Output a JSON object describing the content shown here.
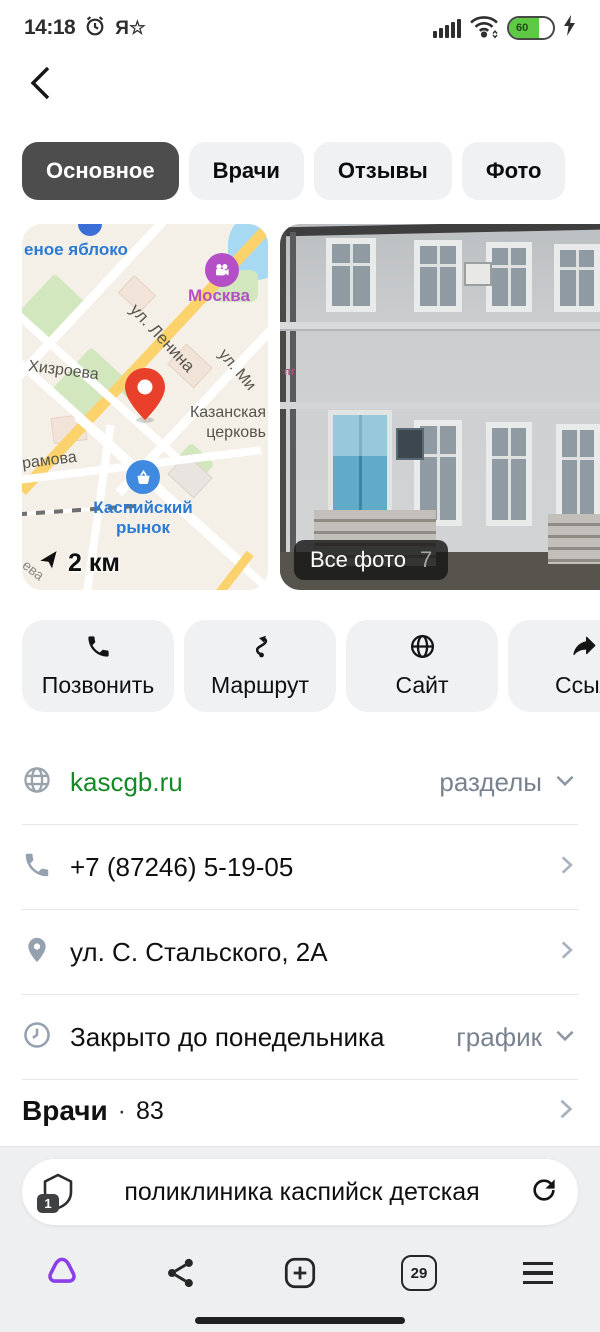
{
  "status_bar": {
    "time": "14:18",
    "notification_glyph": "Я☆",
    "battery_percent": "60"
  },
  "tabs": [
    {
      "label": "Основное",
      "selected": true
    },
    {
      "label": "Врачи",
      "selected": false
    },
    {
      "label": "Отзывы",
      "selected": false
    },
    {
      "label": "Фото",
      "selected": false
    }
  ],
  "map": {
    "distance_label": "2 км",
    "labels": {
      "store": "еное яблоко",
      "cinema": "Москва",
      "lenina": "ул. Ленина",
      "khizroeva": "Хизроева",
      "mi": "ул. Ми",
      "church1": "Казанская",
      "church2": "церковь",
      "market1": "Каспийский",
      "market2": "рынок",
      "ramova": "рамова",
      "eva": "ева"
    }
  },
  "photo": {
    "badge_label": "Все фото",
    "badge_count": "7",
    "wall_sign": "пг"
  },
  "actions": [
    {
      "label": "Позвонить",
      "icon": "phone-icon"
    },
    {
      "label": "Маршрут",
      "icon": "route-icon"
    },
    {
      "label": "Сайт",
      "icon": "globe-icon"
    },
    {
      "label": "Ссыл",
      "icon": "share-icon"
    }
  ],
  "info_rows": [
    {
      "icon": "globe-icon",
      "text": "kascgb.ru",
      "right_label": "разделы",
      "chevron": "down"
    },
    {
      "icon": "phone-icon",
      "text": "+7 (87246) 5-19-05",
      "chevron": "right"
    },
    {
      "icon": "pin-icon",
      "text": "ул. С. Стальского, 2А",
      "chevron": "right"
    },
    {
      "icon": "clock-icon",
      "text": "Закрыто до понедельника",
      "right_label": "график",
      "chevron": "down"
    }
  ],
  "doctors_section": {
    "title": "Врачи",
    "separator": "·",
    "count": "83"
  },
  "omnibox": {
    "query": "поликлиника каспийск детская",
    "tabs_badge": "1"
  },
  "bottom_nav": {
    "tabs_count": "29"
  },
  "colors": {
    "accent_purple": "#8b3fe8",
    "link_green": "#148a26",
    "pin_red": "#e8402a",
    "battery_green": "#5ec943",
    "selected_tab": "#4d4d4d"
  }
}
